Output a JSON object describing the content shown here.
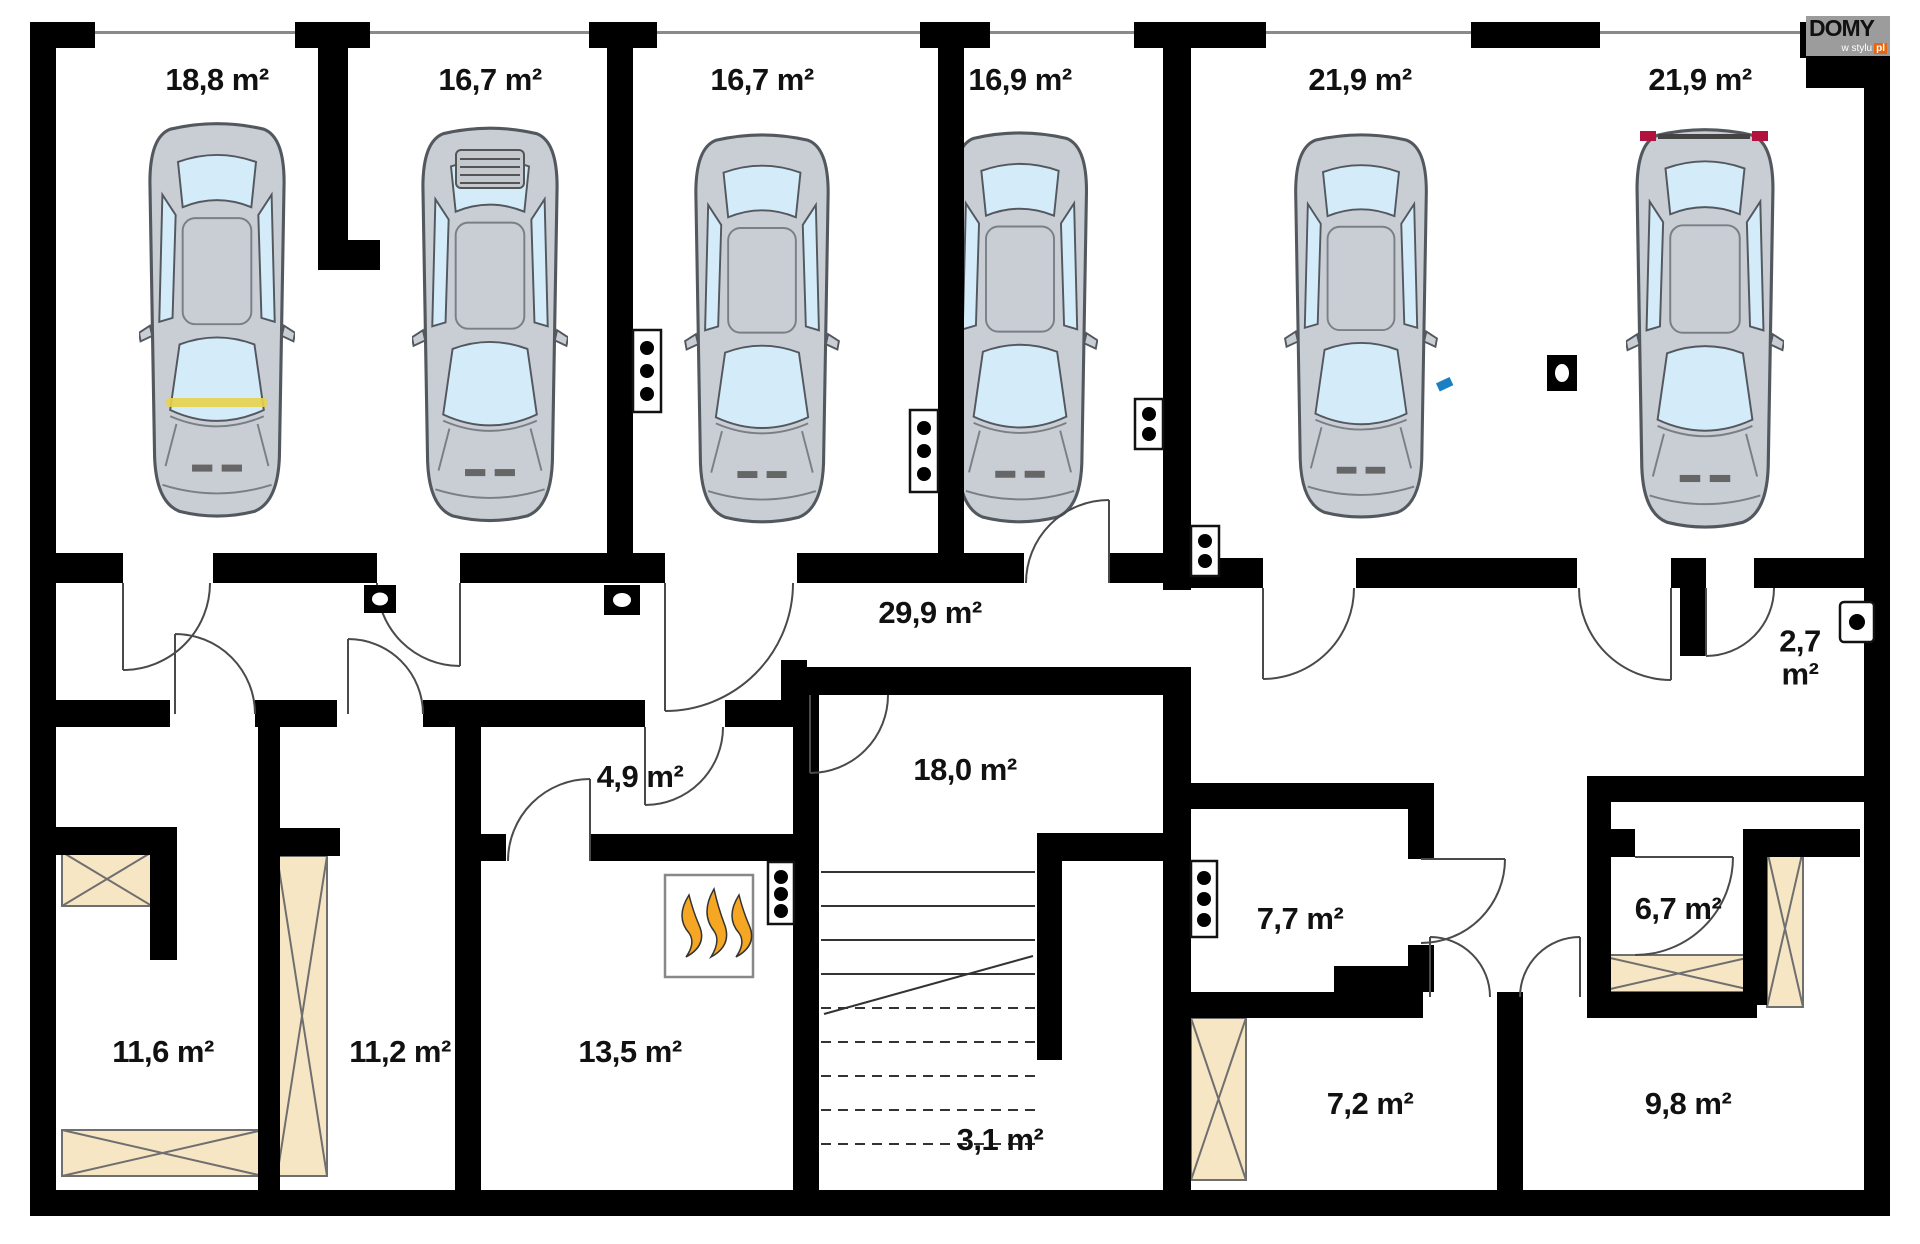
{
  "logo": {
    "name": "DOMY",
    "tagline": "w stylu",
    "domain": "pl"
  },
  "rooms": [
    {
      "id": "garage-1",
      "label": "18,8 m²"
    },
    {
      "id": "garage-2",
      "label": "16,7 m²"
    },
    {
      "id": "garage-3",
      "label": "16,7 m²"
    },
    {
      "id": "garage-4",
      "label": "16,9 m²"
    },
    {
      "id": "garage-5",
      "label": "21,9 m²"
    },
    {
      "id": "garage-6",
      "label": "21,9 m²"
    },
    {
      "id": "corridor",
      "label": "29,9 m²"
    },
    {
      "id": "vestibule",
      "label": "2,7 m²"
    },
    {
      "id": "room-4-9",
      "label": "4,9 m²"
    },
    {
      "id": "stair-hall-18-0",
      "label": "18,0 m²"
    },
    {
      "id": "room-7-7",
      "label": "7,7 m²"
    },
    {
      "id": "room-6-7",
      "label": "6,7 m²"
    },
    {
      "id": "room-11-6",
      "label": "11,6 m²"
    },
    {
      "id": "room-11-2",
      "label": "11,2 m²"
    },
    {
      "id": "room-13-5",
      "label": "13,5 m²"
    },
    {
      "id": "room-3-1",
      "label": "3,1 m²"
    },
    {
      "id": "room-7-2",
      "label": "7,2 m²"
    },
    {
      "id": "room-9-8",
      "label": "9,8 m²"
    }
  ],
  "colors": {
    "wall": "#000000",
    "shaft_fill": "#f7e6c4",
    "window_glass": "#d4ecf9",
    "car_body": "#c9ced5",
    "flame": "#f5a623",
    "logo_orange": "#e8650d",
    "door_arc": "#4a4a4a"
  }
}
